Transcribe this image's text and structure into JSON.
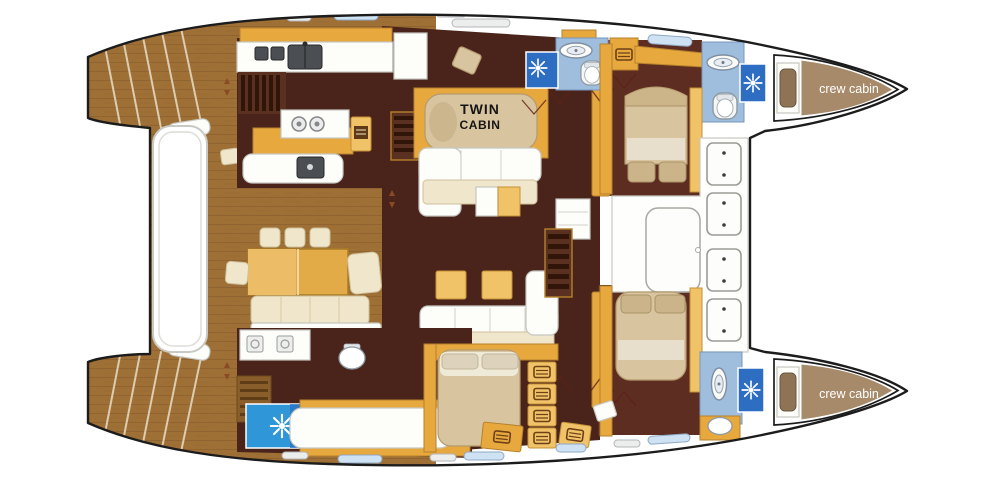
{
  "labels": {
    "twin_cabin_line1": "TWIN",
    "twin_cabin_line2": "CABIN",
    "crew_cabin_port": "crew cabin",
    "crew_cabin_starboard": "crew cabin"
  },
  "palette": {
    "hull_outline": "#1c1c1c",
    "wood_deck": "#9e7036",
    "wood_plank_line": "#7c5526",
    "saloon_floor": "#4a241b",
    "cabin_floor": "#5d2d21",
    "cabinet_yellow": "#e7a83e",
    "cabinet_yellow_light": "#f1c369",
    "cushion_cream": "#efe6cb",
    "bed_tan": "#d8c5a0",
    "bath_floor_blue": "#9fbedd",
    "shower_blue": "#2d6ec3",
    "shower_blue_bright": "#2f97d8",
    "crew_cabin_tan": "#a78a69",
    "counter_gray": "#b9bdc1",
    "label_black": "#151515",
    "label_white": "#ffffff"
  },
  "icons": {
    "shower_light": "starburst",
    "washbasin": "oval-basin",
    "toilet": "rounded-bowl",
    "drawer_locker": "drawer-pictogram",
    "round_hatch": "spoked-wheel",
    "cooktop": "two-burners",
    "cockpit_seat": "square-seat-with-buttons"
  }
}
